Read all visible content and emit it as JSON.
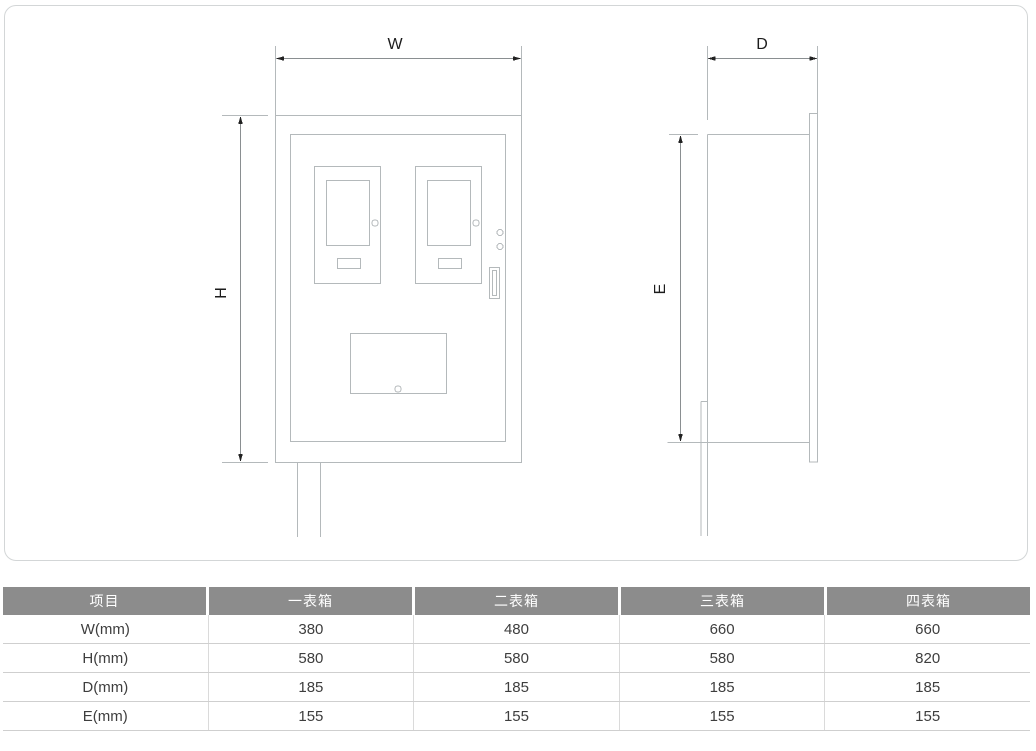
{
  "diagram": {
    "labels": {
      "w": "W",
      "h": "H",
      "d": "D",
      "e": "E"
    }
  },
  "table": {
    "headers": [
      "项目",
      "一表箱",
      "二表箱",
      "三表箱",
      "四表箱"
    ],
    "rows": [
      {
        "label": "W(mm)",
        "values": [
          "380",
          "480",
          "660",
          "660"
        ]
      },
      {
        "label": "H(mm)",
        "values": [
          "580",
          "580",
          "580",
          "820"
        ]
      },
      {
        "label": "D(mm)",
        "values": [
          "185",
          "185",
          "185",
          "185"
        ]
      },
      {
        "label": "E(mm)",
        "values": [
          "155",
          "155",
          "155",
          "155"
        ]
      }
    ]
  },
  "colors": {
    "outline": "#b4b9bb",
    "dimension_line": "#8a8f91",
    "arrow": "#222222",
    "label_text": "#1c1c1c",
    "header_bg": "#8c8c8c",
    "header_text": "#ffffff",
    "cell_text": "#3e3e3e",
    "row_separator": "#cfcfcf",
    "panel_border": "#d3d6d7"
  }
}
